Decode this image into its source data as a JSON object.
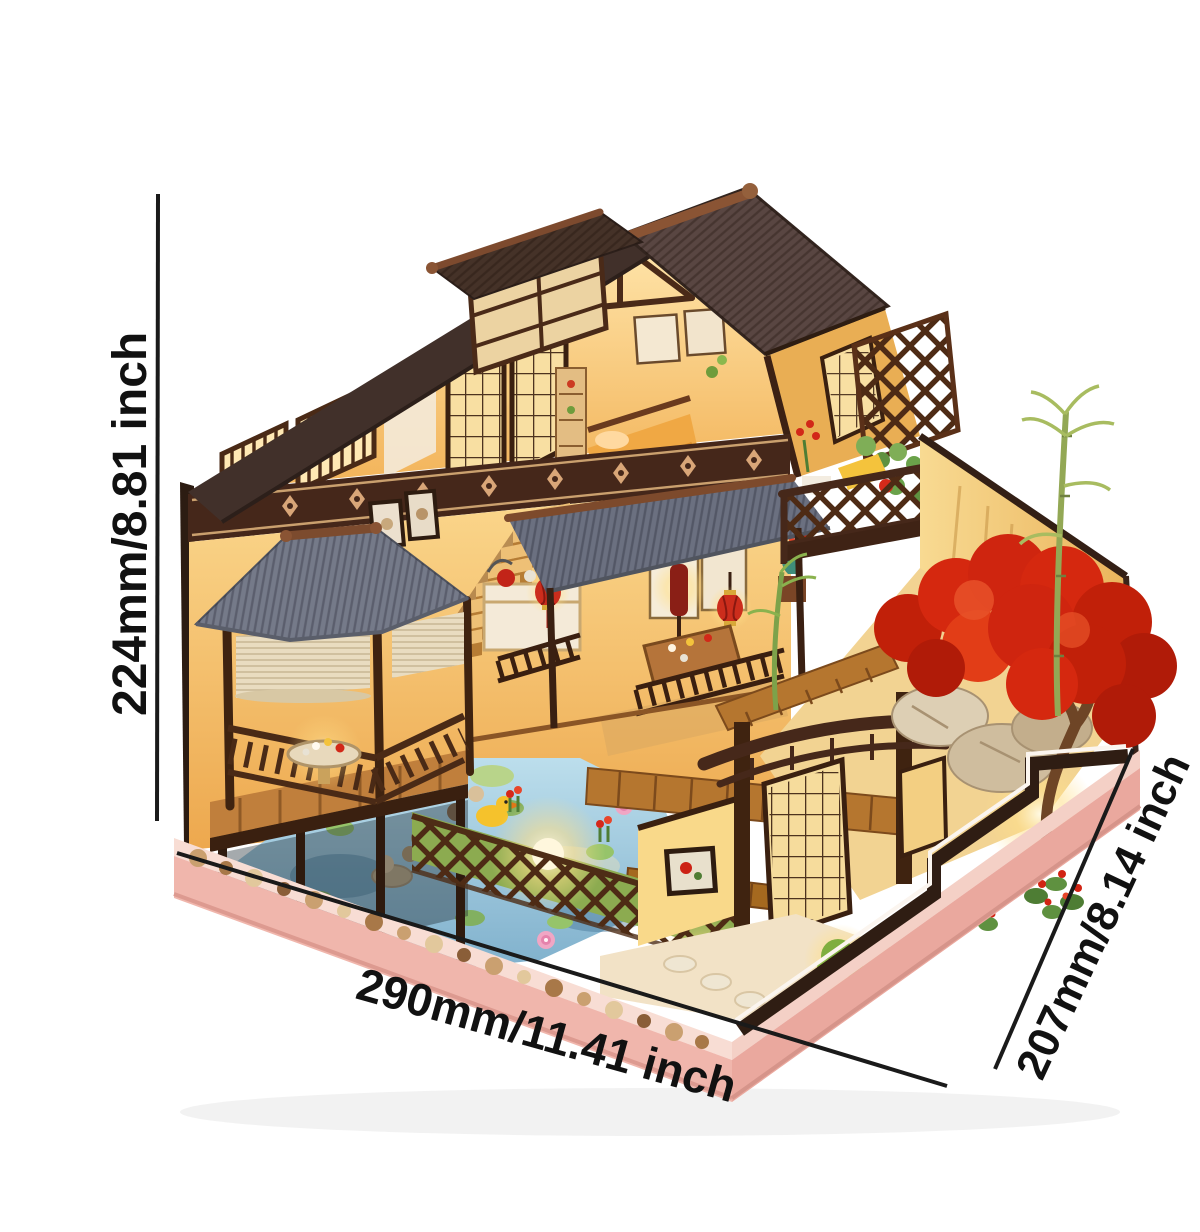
{
  "image": {
    "kind": "e-commerce product photo with dimension annotations",
    "subject": "Illuminated DIY miniature wooden dollhouse: two-storey Japanese-style house with balcony, garden gazebo, koi pond, lattice fence, gate, red maple tree and bamboo on a pink wooden base",
    "background_color": "#ffffff"
  },
  "annotations": {
    "height": {
      "label": "224mm/8.81 inch",
      "orientation": "vertical, left side"
    },
    "width": {
      "label": "290mm/11.41 inch",
      "orientation": "diagonal, bottom front edge"
    },
    "depth": {
      "label": "207mm/8.14 inch",
      "orientation": "diagonal, right front edge"
    }
  },
  "palette": {
    "annotation_text": "#111111",
    "annotation_line": "#1a1a1a",
    "main_roof_brown": "#594642",
    "gray_roof": "#757a89",
    "timber_dark": "#3f2310",
    "frieze_brown": "#45271a",
    "frieze_motif": "#d9a678",
    "interior_glow": "#ffe2a4",
    "interior_deep": "#f2b257",
    "pond_blue": "#9fc9dd",
    "maple_red": "#cf250f",
    "foliage_green": "#7fa84e",
    "base_pink": "#f0b6ac",
    "lantern_red": "#cc2d1c",
    "deck_wood": "#b5762f"
  },
  "scene_elements": [
    "main gable roof",
    "dormer tower",
    "second-floor bedroom",
    "open lattice doors",
    "carved frieze band",
    "balcony with trellis and plants",
    "staircase",
    "framed wall art",
    "kitchen counter",
    "red lanterns",
    "dining table",
    "veranda awning",
    "garden gazebo with round table",
    "bamboo blinds",
    "koi pond with lily pads and lotus",
    "yellow duck",
    "wooden deck walkway",
    "criss-cross garden fence with lights",
    "garden gate with curved beam",
    "red maple tree",
    "rock garden",
    "bamboo stalks",
    "green shrubs",
    "stone border",
    "pink display base"
  ]
}
